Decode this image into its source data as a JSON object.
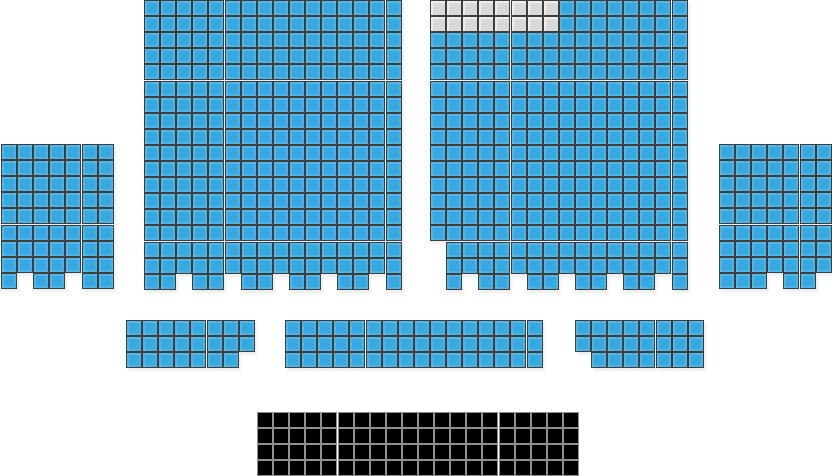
{
  "canvas": {
    "width": 832,
    "height": 476,
    "background": "#ffffff"
  },
  "seat_size": 16.1,
  "colors": {
    "available": "#38a9e0",
    "available_border": "#3e3e3e",
    "unavailable": "#d9d9d9",
    "unavailable_border": "#3e3e3e",
    "stage": "#000000",
    "stage_border": "#909090"
  },
  "seat_states": {
    "available_type": "available",
    "unavailable_type": "unavailable",
    "stage_type": "stage"
  },
  "blocks": [
    {
      "id": "section-upper-left",
      "x": 144,
      "y": 0,
      "cols": 16,
      "rows": 18,
      "type": "available",
      "missing": [
        [
          17,
          2
        ],
        [
          17,
          5
        ],
        [
          17,
          8
        ],
        [
          17,
          11
        ],
        [
          17,
          14
        ]
      ]
    },
    {
      "id": "section-upper-right",
      "x": 430,
      "y": 0,
      "cols": 16,
      "rows": 18,
      "type": "available",
      "missing": [
        [
          15,
          0
        ],
        [
          16,
          0
        ],
        [
          17,
          0
        ],
        [
          17,
          2
        ],
        [
          17,
          5
        ],
        [
          17,
          8
        ],
        [
          17,
          11
        ],
        [
          17,
          14
        ]
      ],
      "unavailable_rect": {
        "row_start": 0,
        "row_end": 1,
        "col_start": 0,
        "col_end": 7
      }
    },
    {
      "id": "section-left-side",
      "x": 1,
      "y": 144,
      "cols": 7,
      "rows": 9,
      "type": "available",
      "missing": [
        [
          8,
          1
        ],
        [
          8,
          4
        ]
      ]
    },
    {
      "id": "section-right-side",
      "x": 719,
      "y": 144,
      "cols": 7,
      "rows": 9,
      "type": "available",
      "missing": [
        [
          8,
          3
        ],
        [
          8,
          6
        ]
      ]
    },
    {
      "id": "section-mid-left",
      "x": 126,
      "y": 320,
      "cols": 8,
      "rows": 3,
      "type": "available",
      "missing": [
        [
          2,
          7
        ]
      ]
    },
    {
      "id": "section-mid-center",
      "x": 285,
      "y": 320,
      "cols": 16,
      "rows": 3,
      "type": "available",
      "missing": []
    },
    {
      "id": "section-mid-right",
      "x": 575,
      "y": 320,
      "cols": 8,
      "rows": 3,
      "type": "available",
      "missing": [
        [
          2,
          0
        ]
      ]
    },
    {
      "id": "stage",
      "x": 257,
      "y": 412,
      "cols": 20,
      "rows": 4,
      "type": "stage",
      "missing": []
    }
  ]
}
